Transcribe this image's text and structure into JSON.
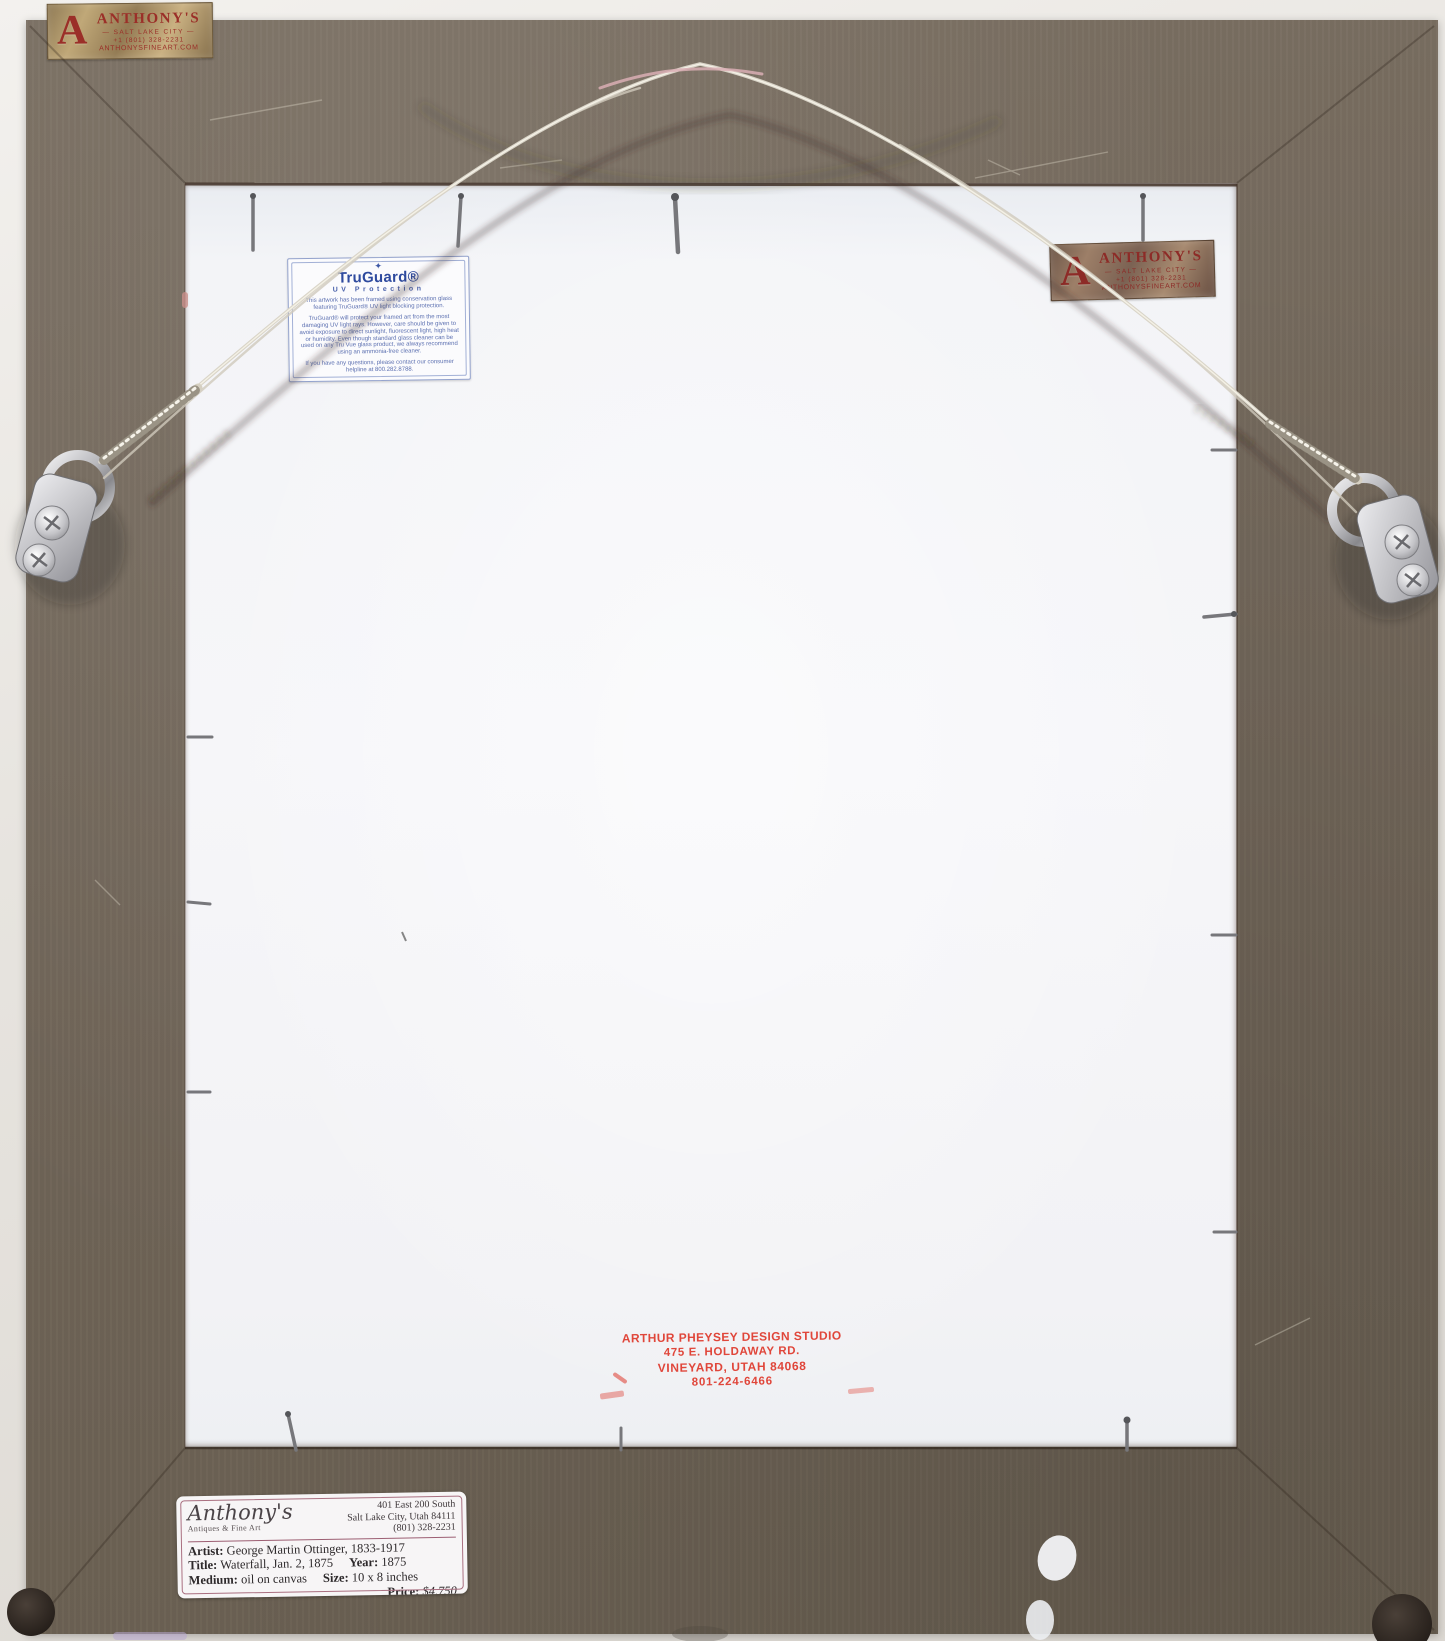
{
  "colors": {
    "wall": "#e9e6e1",
    "frame": "#6f6457",
    "paper": "#f4f5f8",
    "stamp_red": "#df392c",
    "truvue_blue": "#2e4a9e",
    "plaque_red": "#9b2f28",
    "label_rule_maroon": "#9c5e72"
  },
  "plaque_top_left": {
    "logo": "A",
    "name": "ANTHONY'S",
    "city": "— SALT LAKE CITY —",
    "phone": "+1 (801) 328-2231",
    "website": "ANTHONYSFINEART.COM"
  },
  "plaque_top_right": {
    "logo": "A",
    "name": "ANTHONY'S",
    "city": "— SALT LAKE CITY —",
    "phone": "+1 (801) 328-2231",
    "website": "ANTHONYSFINEART.COM"
  },
  "truguard_label": {
    "rays": "✦",
    "brand": "TruGuard®",
    "subtitle": "UV Protection",
    "para1": "This artwork has been framed using conservation glass featuring TruGuard® UV light blocking protection.",
    "para2": "TruGuard® will protect your framed art from the most damaging UV light rays. However, care should be given to avoid exposure to direct sunlight, fluorescent light, high heat or humidity. Even though standard glass cleaner can be used on any Tru Vue glass product, we always recommend using an ammonia-free cleaner.",
    "para3": "If you have any questions, please contact our consumer helpline at 800.282.8788.",
    "footer_icon": "©",
    "footer_brand": "TRU VUE®"
  },
  "design_stamp": {
    "line1": "ARTHUR PHEYSEY DESIGN STUDIO",
    "line2": "475 E. HOLDAWAY RD.",
    "line3": "VINEYARD, UTAH 84068",
    "line4": "801-224-6466"
  },
  "gallery_label": {
    "store_name": "Anthony's",
    "store_sub": "Antiques & Fine Art",
    "address_line1": "401 East 200 South",
    "address_line2": "Salt Lake City, Utah 84111",
    "address_line3": "(801) 328-2231",
    "artist_label": "Artist:",
    "artist_value": "George Martin Ottinger, 1833-1917",
    "title_label": "Title:",
    "title_value": "Waterfall, Jan. 2, 1875",
    "year_label": "Year:",
    "year_value": "1875",
    "medium_label": "Medium:",
    "medium_value": "oil on canvas",
    "size_label": "Size:",
    "size_value": "10 x 8 inches",
    "price_label": "Price:",
    "price_value": "$4,750"
  }
}
